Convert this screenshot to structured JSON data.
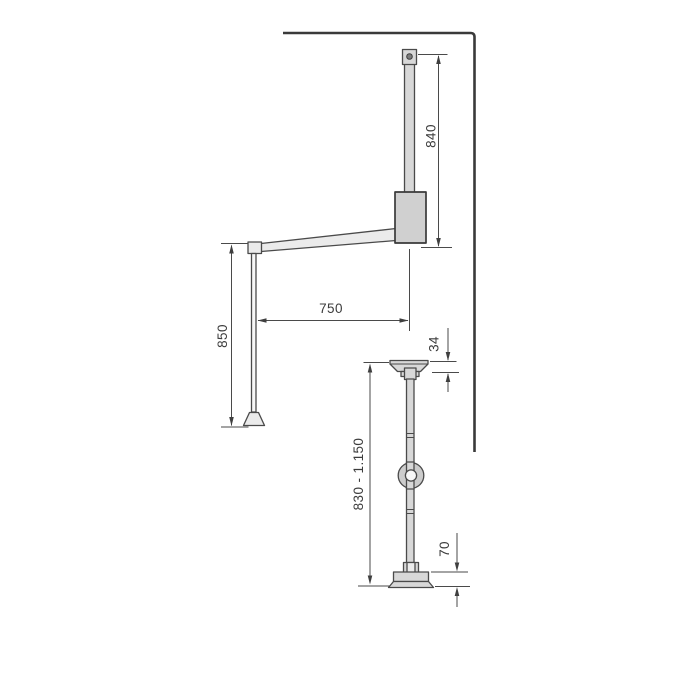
{
  "diagram": {
    "type": "technical-dimension-drawing",
    "subject": "pull-down wardrobe lift arm (side view) and adjustable support pole (front view)",
    "colors": {
      "background": "#ffffff",
      "outline": "#4a4a4a",
      "wall_line": "#3a3a3a",
      "fill_light": "#ebebeb",
      "fill_gray": "#d8d8d8",
      "fill_dark_gray": "#d0d0d0",
      "label_text": "#3c3c3c"
    },
    "labels": {
      "bar_height": "840",
      "arm_length": "750",
      "rod_drop": "850",
      "cap_depth": "34",
      "pole_range": "830 - 1.150",
      "base_height": "70"
    }
  }
}
